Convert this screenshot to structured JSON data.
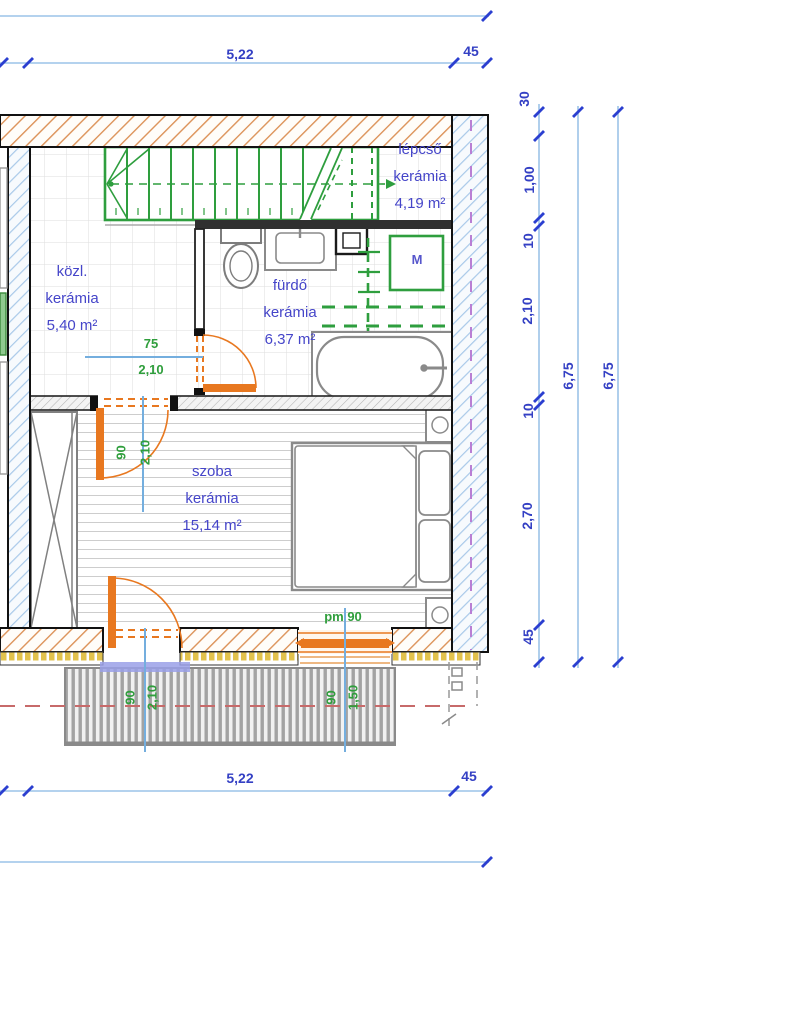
{
  "dimensions": {
    "top": {
      "width": "5,22",
      "offset": "45"
    },
    "bottom": {
      "width": "5,22",
      "offset": "45"
    },
    "right_chain": {
      "v1": "30",
      "v2": "1,00",
      "v3": "10",
      "v4": "2,10",
      "v5": "10",
      "v6": "2,70",
      "v7": "45"
    },
    "right_total_inner": "6,75",
    "right_total_outer": "6,75"
  },
  "rooms": {
    "lepcso": {
      "name": "lépcső",
      "material": "kerámia",
      "area": "4,19 m²"
    },
    "kozl": {
      "name": "közl.",
      "material": "kerámia",
      "area": "5,40 m²"
    },
    "furdo": {
      "name": "fürdő",
      "material": "kerámia",
      "area": "6,37 m²"
    },
    "szoba": {
      "name": "szoba",
      "material": "kerámia",
      "area": "15,14 m²"
    }
  },
  "fixtures": {
    "washing_machine_label": "M"
  },
  "openings": {
    "bath_door": {
      "width": "75",
      "height": "2,10"
    },
    "room_door": {
      "width": "90",
      "height": "2,10"
    },
    "balcony_door": {
      "width": "90",
      "height": "2,10"
    },
    "window": {
      "width": "90",
      "height": "1,50",
      "sill": "pm 90"
    }
  },
  "colors": {
    "wall_hatch_orange": "#dc9258",
    "wall_hatch_blue": "#a9c9e9",
    "stairs_green": "#2e9e3e",
    "annotation_green": "#2f9e3c",
    "dimension_blue": "#3440c4",
    "door_orange": "#e87820",
    "axis_blue": "#74aede",
    "label_purple": "#4545c9"
  }
}
